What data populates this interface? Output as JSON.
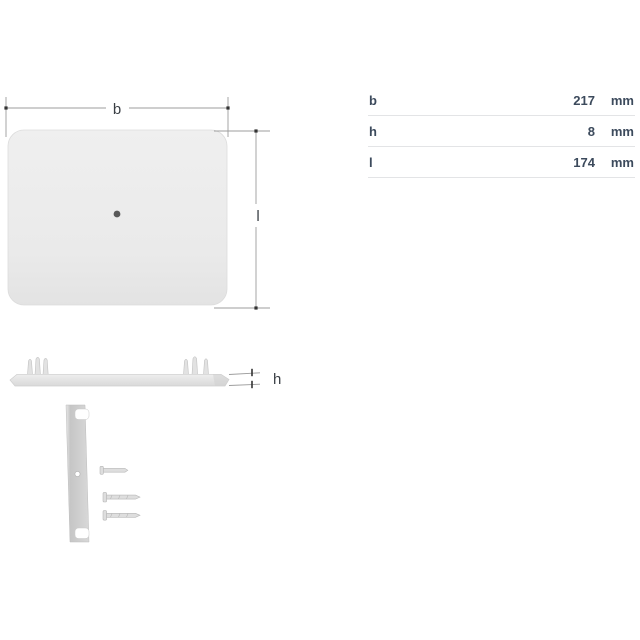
{
  "drawing": {
    "labels": {
      "width": "b",
      "length": "l",
      "height": "h"
    }
  },
  "table": {
    "rows": [
      {
        "label": "b",
        "value": "217",
        "unit": "mm"
      },
      {
        "label": "h",
        "value": "8",
        "unit": "mm"
      },
      {
        "label": "l",
        "value": "174",
        "unit": "mm"
      }
    ]
  },
  "colors": {
    "table_text": "#3c4a5c",
    "table_border": "#e3e4e6",
    "dimension_line": "#9c9c9c",
    "dimension_mark": "#333333",
    "plate_fill": "#ebebeb",
    "bracket_fill": "#cccccc"
  }
}
